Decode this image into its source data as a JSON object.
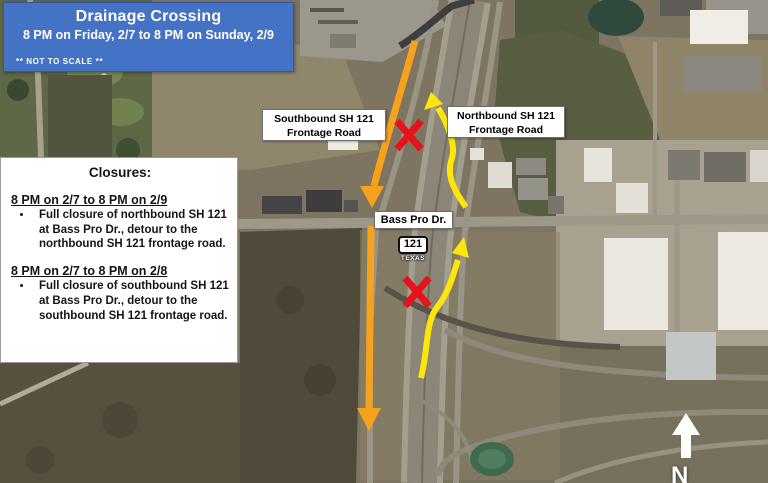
{
  "header": {
    "title": "Drainage Crossing",
    "subtitle": "8 PM on Friday, 2/7 to 8 PM on Sunday, 2/9",
    "scale_note": "** NOT TO SCALE **"
  },
  "closures": {
    "title": "Closures:",
    "entries": [
      {
        "period": "8 PM on 2/7 to 8 PM on 2/9",
        "detail": "Full closure of northbound SH 121 at Bass Pro Dr., detour to the northbound SH 121 frontage road."
      },
      {
        "period": "8 PM on 2/7 to 8 PM on 2/8",
        "detail": "Full closure of southbound SH 121 at Bass Pro Dr., detour to the southbound SH 121 frontage road."
      }
    ]
  },
  "map": {
    "labels": {
      "southbound_frontage": {
        "line1": "Southbound SH 121",
        "line2": "Frontage Road"
      },
      "northbound_frontage": {
        "line1": "Northbound SH 121",
        "line2": "Frontage Road"
      },
      "cross_street": "Bass Pro Dr."
    },
    "route_shield": {
      "number": "121",
      "state": "TEXAS"
    },
    "compass": "N",
    "annotation_colors": {
      "southbound_detour": "#F6A21C",
      "northbound_detour": "#FFE60A",
      "closure_marker": "#E8121A",
      "header_bg": "#4472C4"
    }
  }
}
